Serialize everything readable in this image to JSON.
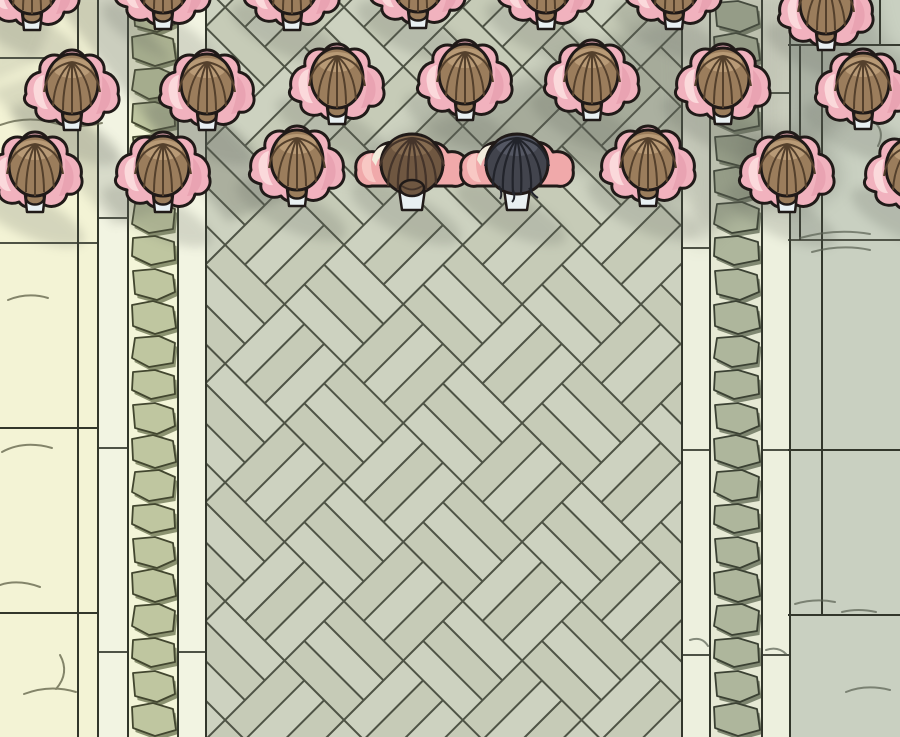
{
  "scene": {
    "description": "Overhead manga panel: rows of attendants in pink shawls with brown hair buns stand on a courtyard floor; two main characters (brown ponytail, black hair) stand on a diagonal parquet walkway between cobblestone strips, white curbs and marble tiles; soft diagonal shadows fall across the top right.",
    "canvas": {
      "width": 900,
      "height": 737
    },
    "palette": {
      "marble-left": "#f3f3d5",
      "marble-right": "#c9d0c1",
      "curb": "#f2f4e2",
      "curb-right": "#edf0de",
      "cobble-face-left": "#bfc6a0",
      "cobble-side-left": "#8b9270",
      "cobble-gap-left": "#f3f5d8",
      "cobble-face-right": "#aeb69c",
      "cobble-side-right": "#7f8771",
      "cobble-gap-right": "#e6e9d4",
      "parquet-bg": "#cbd0bd",
      "parquet-plank-a": "#cdd2c0",
      "parquet-plank-b": "#c6cbb7",
      "parquet-line": "#4e5345",
      "tile-line": "#32362b",
      "vein-left": "#5e5f46",
      "vein-right": "#596052",
      "shadow": "#5e645a",
      "outline": "#201a18",
      "shawl": "#f1b2be",
      "shawl-hi": "#fbd9db",
      "shawl-shade": "#e293a6",
      "lining": "#f2ecdc",
      "collar": "#e9f0f2",
      "hair": "#9b7d5c",
      "hair-dark": "#54402c",
      "hair-hi": "#bb9d79",
      "skin": "#f0a9aa",
      "skin-hi": "#f8cbc6",
      "hair-brown": "#6f5741",
      "hair-brown-dark": "#44342a",
      "hair-brown-hi": "#8a6e53",
      "hair-black": "#42444d",
      "hair-black-dark": "#22242b",
      "hair-black-hi": "#646877"
    },
    "people": {
      "rows": [
        "back",
        "middle",
        "front"
      ],
      "counts": {
        "back": 7,
        "middle": 7,
        "front": 8
      },
      "figures": [
        {
          "x": 32,
          "y": -14,
          "t": "crowd",
          "row": "back"
        },
        {
          "x": 163,
          "y": -15,
          "t": "crowd",
          "row": "back"
        },
        {
          "x": 292,
          "y": -14,
          "t": "crowd",
          "row": "back"
        },
        {
          "x": 418,
          "y": -16,
          "t": "crowd",
          "row": "back"
        },
        {
          "x": 546,
          "y": -15,
          "t": "crowd",
          "row": "back"
        },
        {
          "x": 674,
          "y": -15,
          "t": "crowd",
          "row": "back"
        },
        {
          "x": 826,
          "y": 6,
          "t": "crowd",
          "row": "back"
        },
        {
          "x": 72,
          "y": 86,
          "t": "crowd",
          "row": "middle"
        },
        {
          "x": 207,
          "y": 86,
          "t": "crowd",
          "row": "middle"
        },
        {
          "x": 337,
          "y": 80,
          "t": "crowd",
          "row": "middle"
        },
        {
          "x": 465,
          "y": 76,
          "t": "crowd",
          "row": "middle"
        },
        {
          "x": 592,
          "y": 76,
          "t": "crowd",
          "row": "middle"
        },
        {
          "x": 723,
          "y": 80,
          "t": "crowd",
          "row": "middle"
        },
        {
          "x": 863,
          "y": 85,
          "t": "crowd",
          "row": "middle"
        },
        {
          "x": 35,
          "y": 168,
          "t": "crowd",
          "row": "front"
        },
        {
          "x": 163,
          "y": 168,
          "t": "crowd",
          "row": "front"
        },
        {
          "x": 297,
          "y": 162,
          "t": "crowd",
          "row": "front"
        },
        {
          "x": 412,
          "y": 166,
          "t": "brown",
          "row": "front"
        },
        {
          "x": 517,
          "y": 166,
          "t": "black",
          "row": "front"
        },
        {
          "x": 648,
          "y": 162,
          "t": "crowd",
          "row": "front"
        },
        {
          "x": 787,
          "y": 168,
          "t": "crowd",
          "row": "front"
        },
        {
          "x": 912,
          "y": 170,
          "t": "crowd",
          "row": "front"
        }
      ]
    },
    "shadows": [
      {
        "name": "corner-top-left",
        "points": "-10,-10 66,-10 34,64 -10,84",
        "opacity": 0.15,
        "blur": "small"
      },
      {
        "name": "streak-left",
        "points": "44,-10 112,-10 290,196 228,222",
        "opacity": 0.26,
        "blur": "small"
      },
      {
        "name": "streak-left-lower",
        "points": "-10,90 36,74 170,206 114,226",
        "opacity": 0.17,
        "blur": "small"
      },
      {
        "name": "parquet-shadow-band",
        "points": "336,176 420,126 500,90 570,56 628,30 676,12 682,40 684,120 686,200 650,196 600,176 540,160 470,166 400,178",
        "opacity": 0.3,
        "blur": "big"
      },
      {
        "name": "stone-path-shadow",
        "points": "676,-12 790,-12 790,40 786,110 780,170 768,205 748,210 726,222 708,236 698,250 688,210 683,120 680,40",
        "opacity": 0.3,
        "blur": "big"
      },
      {
        "name": "marble-shadow-right",
        "points": "788,-12 872,-12 878,20 886,44 912,60 912,80 890,86 874,94 856,110 832,130 814,152 800,164 788,152",
        "opacity": 0.28,
        "blur": "big"
      },
      {
        "name": "marble-shadow-blob",
        "points": "744,132 796,124 836,150 842,186 806,214 760,206 738,172",
        "opacity": 0.24,
        "blur": "big"
      }
    ],
    "figure_shadow": {
      "dx": -6,
      "dy": 48,
      "rx": 60,
      "ry": 20,
      "rotate": 25,
      "opacity": 0.2
    }
  }
}
